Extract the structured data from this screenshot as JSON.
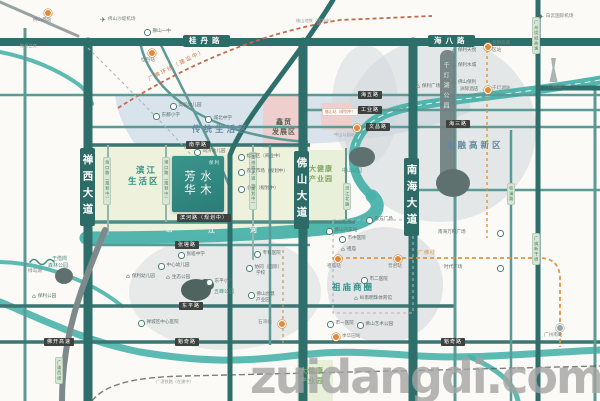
{
  "watermark": "zuidangdi.com",
  "logo": {
    "brand": "保利",
    "name": "水木芳华"
  },
  "map": {
    "road_plates": [
      {
        "t": "桂丹路",
        "cls": "tplate",
        "x": 183,
        "y": 35
      },
      {
        "t": "海八路",
        "cls": "tplate",
        "x": 428,
        "y": 35
      },
      {
        "t": "禅西大道",
        "cls": "vbig",
        "x": 80,
        "y": 148
      },
      {
        "t": "佛山大道",
        "cls": "vbig",
        "x": 294,
        "y": 151
      },
      {
        "t": "南海大道",
        "cls": "vbig",
        "x": 404,
        "y": 158
      },
      {
        "t": "南学路",
        "cls": "hplate",
        "x": 186,
        "y": 141
      },
      {
        "t": "滨河路（规划中）",
        "cls": "hplate",
        "x": 177,
        "y": 214
      },
      {
        "t": "张槎路",
        "cls": "hplate",
        "x": 175,
        "y": 241
      },
      {
        "t": "东平路",
        "cls": "hplate",
        "x": 179,
        "y": 302
      },
      {
        "t": "魁奇路",
        "cls": "hplate",
        "x": 175,
        "y": 338
      },
      {
        "t": "魁奇路",
        "cls": "hplate",
        "x": 441,
        "y": 338
      },
      {
        "t": "佛开高速",
        "cls": "hplate",
        "x": 44,
        "y": 338
      },
      {
        "t": "海五路",
        "cls": "hplate",
        "x": 358,
        "y": 91
      },
      {
        "t": "工业路",
        "cls": "hplate",
        "x": 358,
        "y": 106
      },
      {
        "t": "文昌路",
        "cls": "hplate",
        "x": 366,
        "y": 123
      },
      {
        "t": "海三路",
        "cls": "hplate",
        "x": 446,
        "y": 120
      },
      {
        "t": "海口路（规划中）",
        "cls": "vplate",
        "x": 103,
        "y": 157
      },
      {
        "t": "港口路（规划中）",
        "cls": "vplate",
        "x": 162,
        "y": 157
      },
      {
        "t": "王借岗大道（规划中）",
        "cls": "vplate",
        "x": 249,
        "y": 152
      },
      {
        "t": "汾江北路",
        "cls": "vplate",
        "x": 343,
        "y": 183
      },
      {
        "t": "桂澜路",
        "cls": "vplate",
        "x": 507,
        "y": 183
      },
      {
        "t": "广州绕城高速",
        "cls": "vplate",
        "x": 532,
        "y": 17
      },
      {
        "t": "广佛新干线",
        "cls": "vplate",
        "x": 532,
        "y": 233
      },
      {
        "t": "广珠西线",
        "cls": "vplate",
        "x": 55,
        "y": 357
      }
    ],
    "labels": [
      {
        "t": "",
        "icon": "station",
        "x": 44,
        "y": 9,
        "name": "foshan-west-station-icon"
      },
      {
        "t": "佛山西站",
        "cls": "poi-gray",
        "x": 33,
        "y": 19
      },
      {
        "t": "桂丹立交",
        "cls": "gray-sm",
        "x": 20,
        "y": 44
      },
      {
        "t": "佛山沙堤机场",
        "icon": "plane",
        "cls": "poi-gray",
        "x": 100,
        "y": 17
      },
      {
        "t": "狮山一中",
        "icon": "circ",
        "x": 144,
        "y": 29
      },
      {
        "t": "",
        "icon": "station",
        "x": 148,
        "y": 49,
        "name": "guidan-station-icon"
      },
      {
        "t": "桂丹站",
        "cls": "poi-gray",
        "x": 141,
        "y": 59
      },
      {
        "t": "广佛环线（建设中）",
        "cls": "slant",
        "x": 148,
        "y": 78,
        "rot": -27
      },
      {
        "t": "佛山地铁（规划中）",
        "cls": "gray-sm",
        "x": 296,
        "y": 19
      },
      {
        "t": "白云国际机场",
        "icon": "plane",
        "cls": "poi-gray",
        "x": 538,
        "y": 14
      },
      {
        "t": "广州塔",
        "cls": "poi-gray",
        "x": 548,
        "y": 86
      },
      {
        "t": "实验幼儿园",
        "icon": "circ",
        "x": 170,
        "y": 103
      },
      {
        "t": "东鄱小学",
        "icon": "circ",
        "x": 153,
        "y": 113
      },
      {
        "t": "城北中学",
        "icon": "circ",
        "x": 205,
        "y": 116
      },
      {
        "t": "传统生活区",
        "cls": "area-blue",
        "x": 192,
        "y": 126
      },
      {
        "t": "鑫贸",
        "cls": "area-dark",
        "x": 276,
        "y": 119
      },
      {
        "t": "发展区",
        "cls": "area-dark",
        "x": 272,
        "y": 129
      },
      {
        "t": "佛山站（规划中）",
        "cls": "tinybox",
        "x": 322,
        "y": 108
      },
      {
        "t": "同济幼儿园",
        "icon": "circ",
        "x": 194,
        "y": 149
      },
      {
        "t": "滨江",
        "cls": "area-teal",
        "x": 136,
        "y": 167
      },
      {
        "t": "生活区",
        "cls": "area-teal",
        "x": 128,
        "y": 178
      },
      {
        "t": "松园区（商业中）",
        "icon": "circ",
        "x": 238,
        "y": 154
      },
      {
        "t": "农贸市场（规划中）",
        "icon": "circ",
        "x": 238,
        "y": 169
      },
      {
        "t": "小学（规划中）",
        "icon": "circ",
        "x": 238,
        "y": 186
      },
      {
        "t": "大健康",
        "cls": "area-green",
        "x": 309,
        "y": 166
      },
      {
        "t": "产业园",
        "cls": "area-green",
        "x": 309,
        "y": 176
      },
      {
        "t": "大健康",
        "cls": "area-green",
        "x": 300,
        "y": 368
      },
      {
        "t": "产业园",
        "cls": "area-green",
        "x": 300,
        "y": 378
      },
      {
        "t": "汾",
        "cls": "river-ch",
        "x": 166,
        "y": 226
      },
      {
        "t": "江",
        "cls": "river-ch",
        "x": 208,
        "y": 227
      },
      {
        "t": "河",
        "cls": "river-ch",
        "x": 250,
        "y": 227
      },
      {
        "t": "张槎中学",
        "icon": "circ",
        "x": 178,
        "y": 252
      },
      {
        "t": "中心幼儿园",
        "icon": "circ",
        "x": 158,
        "y": 263
      },
      {
        "t": "生态公园",
        "icon": "bldg",
        "x": 166,
        "y": 275
      },
      {
        "t": "保利幼儿园",
        "icon": "bldg",
        "x": 126,
        "y": 274
      },
      {
        "t": "东平小学",
        "icon": "circ",
        "x": 206,
        "y": 279
      },
      {
        "t": "五峰公园",
        "cls": "area-teal-sm",
        "x": 214,
        "y": 290
      },
      {
        "t": "专科医院",
        "icon": "circ",
        "x": 254,
        "y": 251
      },
      {
        "t": "协同（国际）",
        "icon": "circ",
        "x": 246,
        "y": 265
      },
      {
        "t": "学校",
        "cls": "poi",
        "x": 256,
        "y": 272
      },
      {
        "t": "佛山创意",
        "icon": "circ",
        "x": 248,
        "y": 292
      },
      {
        "t": "产业园",
        "cls": "poi",
        "x": 256,
        "y": 299
      },
      {
        "t": "禅城区中心医院",
        "icon": "circ",
        "x": 138,
        "y": 320
      },
      {
        "t": "石湾站",
        "cls": "poi-gray",
        "x": 258,
        "y": 321
      },
      {
        "t": "",
        "icon": "station",
        "x": 278,
        "y": 320,
        "name": "shiwan-station-icon"
      },
      {
        "t": "季华园站",
        "icon": "station",
        "cls": "poi-gray",
        "x": 332,
        "y": 333
      },
      {
        "t": "东方广场",
        "icon": "circ",
        "x": 366,
        "y": 217
      },
      {
        "t": "佛山汽车站",
        "icon": "circ",
        "x": 326,
        "y": 228
      },
      {
        "t": "市中医院",
        "icon": "circ",
        "x": 339,
        "y": 236
      },
      {
        "t": "祖庙",
        "icon": "bldg",
        "x": 341,
        "y": 247
      },
      {
        "t": "市二医院",
        "icon": "circ",
        "x": 361,
        "y": 277
      },
      {
        "t": "祖庙商圈",
        "cls": "area-teal",
        "x": 332,
        "y": 284
      },
      {
        "t": "岭南明珠体育馆",
        "icon": "bldg",
        "x": 354,
        "y": 296
      },
      {
        "t": "市一医院",
        "icon": "circ",
        "x": 327,
        "y": 321
      },
      {
        "t": "佛山艺术公园",
        "icon": "circ",
        "x": 357,
        "y": 322
      },
      {
        "t": "",
        "icon": "station",
        "x": 334,
        "y": 255,
        "name": "zumiao-metro-icon"
      },
      {
        "t": "祖庙站",
        "cls": "poi-gray",
        "x": 327,
        "y": 265
      },
      {
        "t": "",
        "icon": "station",
        "x": 394,
        "y": 255,
        "name": "pujun-metro-icon"
      },
      {
        "t": "普君站",
        "cls": "poi-gray",
        "x": 388,
        "y": 265
      },
      {
        "t": "广佛线",
        "cls": "orange-t",
        "x": 418,
        "y": 251
      },
      {
        "t": "南海万科广场",
        "cls": "poi",
        "x": 438,
        "y": 231
      },
      {
        "t": "",
        "icon": "circ",
        "x": 497,
        "y": 230,
        "name": "wanke-plaza-icon"
      },
      {
        "t": "时代广场",
        "cls": "poi",
        "x": 444,
        "y": 266
      },
      {
        "t": "",
        "icon": "circ",
        "x": 497,
        "y": 265,
        "name": "times-plaza-icon"
      },
      {
        "t": "",
        "icon": "train",
        "x": 556,
        "y": 324,
        "name": "guangzhou-south-icon"
      },
      {
        "t": "广州南站",
        "cls": "poi-gray",
        "x": 544,
        "y": 334
      },
      {
        "t": "保利天悦",
        "icon": "bldg",
        "x": 452,
        "y": 48
      },
      {
        "t": "保利水城",
        "icon": "bldg",
        "x": 452,
        "y": 63
      },
      {
        "t": "佛山保利",
        "icon": "bldg",
        "x": 452,
        "y": 80
      },
      {
        "t": "洲际酒店",
        "cls": "poi",
        "x": 460,
        "y": 88
      },
      {
        "t": "保利广场",
        "icon": "bldg",
        "x": 416,
        "y": 84
      },
      {
        "t": "",
        "icon": "station",
        "x": 484,
        "y": 43,
        "name": "financial-hitech-station-icon"
      },
      {
        "t": "金融高新",
        "cls": "poi-gray",
        "x": 492,
        "y": 42
      },
      {
        "t": "区站",
        "cls": "poi-gray",
        "x": 492,
        "y": 49
      },
      {
        "t": "",
        "icon": "station",
        "x": 484,
        "y": 86,
        "name": "qiandeng-lake-station-icon"
      },
      {
        "t": "千灯湖站",
        "cls": "poi-gray",
        "x": 492,
        "y": 87
      },
      {
        "t": "金融高新区",
        "cls": "area-blue",
        "x": 446,
        "y": 142
      },
      {
        "t": "千灯湖公园",
        "cls": "band-t",
        "x": 442,
        "y": 62,
        "name": "qiandeng-lake-park-label"
      },
      {
        "t": "中山公园",
        "cls": "area-teal-sm",
        "x": 342,
        "y": 169
      },
      {
        "t": "",
        "icon": "station",
        "x": 353,
        "y": 124,
        "name": "zhongshan-park-station-icon"
      },
      {
        "t": "中山公园站",
        "cls": "gray-sm",
        "x": 334,
        "y": 133
      },
      {
        "t": "绿岛湖",
        "cls": "poi-gray",
        "x": 28,
        "y": 270
      },
      {
        "t": "王借岗",
        "cls": "area-teal-sm",
        "x": 52,
        "y": 257
      },
      {
        "t": "森林公园",
        "cls": "area-teal-sm",
        "x": 48,
        "y": 264
      },
      {
        "t": "保利公园",
        "icon": "bldg",
        "x": 32,
        "y": 294
      },
      {
        "t": "广湛铁路（在建中）",
        "cls": "gray-sm",
        "x": 156,
        "y": 380
      }
    ]
  }
}
